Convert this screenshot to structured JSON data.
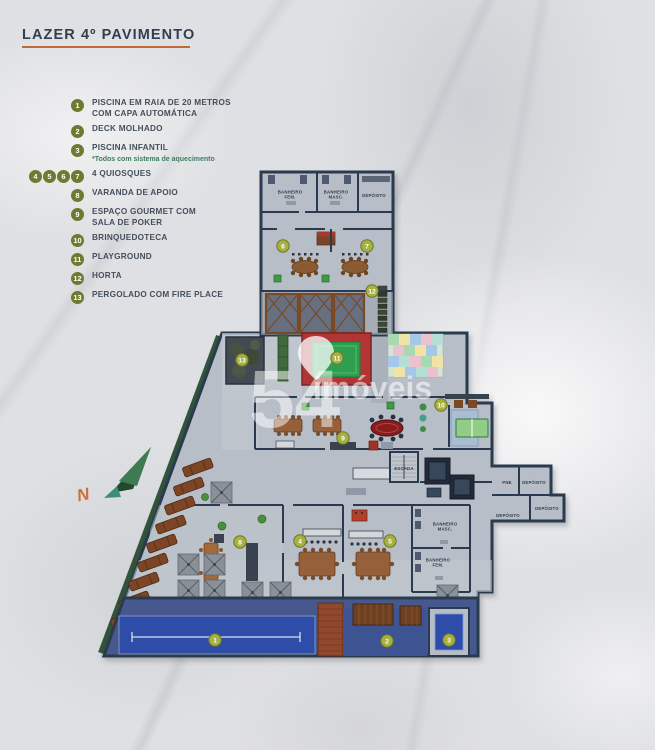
{
  "title": {
    "text": "LAZER 4º PAVIMENTO"
  },
  "legend": {
    "items": [
      {
        "numbers": [
          "1"
        ],
        "label": "PISCINA EM RAIA DE 20 METROS\nCOM CAPA AUTOMÁTICA",
        "note": ""
      },
      {
        "numbers": [
          "2"
        ],
        "label": "DECK MOLHADO",
        "note": ""
      },
      {
        "numbers": [
          "3"
        ],
        "label": "PISCINA INFANTIL",
        "note": "*Todos com sistema de aquecimento"
      },
      {
        "numbers": [
          "4",
          "5",
          "6",
          "7"
        ],
        "label": "4 QUIOSQUES",
        "note": ""
      },
      {
        "numbers": [
          "8"
        ],
        "label": "VARANDA DE APOIO",
        "note": ""
      },
      {
        "numbers": [
          "9"
        ],
        "label": "ESPAÇO GOURMET COM\nSALA DE POKER",
        "note": ""
      },
      {
        "numbers": [
          "10"
        ],
        "label": "BRINQUEDOTECA",
        "note": ""
      },
      {
        "numbers": [
          "11"
        ],
        "label": "PLAYGROUND",
        "note": ""
      },
      {
        "numbers": [
          "12"
        ],
        "label": "HORTA",
        "note": ""
      },
      {
        "numbers": [
          "13"
        ],
        "label": "PERGOLADO COM FIRE PLACE",
        "note": ""
      }
    ]
  },
  "plan": {
    "markers": [
      {
        "n": "1",
        "x": 215,
        "y": 640
      },
      {
        "n": "2",
        "x": 387,
        "y": 641
      },
      {
        "n": "3",
        "x": 449,
        "y": 640
      },
      {
        "n": "4",
        "x": 300,
        "y": 541
      },
      {
        "n": "5",
        "x": 390,
        "y": 541
      },
      {
        "n": "6",
        "x": 283,
        "y": 246
      },
      {
        "n": "7",
        "x": 367,
        "y": 246
      },
      {
        "n": "8",
        "x": 240,
        "y": 542
      },
      {
        "n": "9",
        "x": 343,
        "y": 438
      },
      {
        "n": "10",
        "x": 441,
        "y": 405
      },
      {
        "n": "11",
        "x": 337,
        "y": 358
      },
      {
        "n": "12",
        "x": 372,
        "y": 291
      },
      {
        "n": "13",
        "x": 242,
        "y": 360
      }
    ],
    "rooms": [
      {
        "label": "BANHEIRO\nFEM.",
        "x": 290,
        "y": 196
      },
      {
        "label": "BANHEIRO\nMASC.",
        "x": 336,
        "y": 196
      },
      {
        "label": "DEPÓSITO",
        "x": 374,
        "y": 197
      },
      {
        "label": "ESCADA",
        "x": 404,
        "y": 470
      },
      {
        "label": "PNE",
        "x": 507,
        "y": 484
      },
      {
        "label": "DEPÓSITO",
        "x": 534,
        "y": 484
      },
      {
        "label": "DEPÓSITO",
        "x": 547,
        "y": 510
      },
      {
        "label": "DEPÓSITO",
        "x": 508,
        "y": 517
      },
      {
        "label": "BANHEIRO\nMASC.",
        "x": 445,
        "y": 528
      },
      {
        "label": "BANHEIRO\nFEM.",
        "x": 438,
        "y": 564
      }
    ],
    "compass_label": "N"
  },
  "watermark": {
    "number": "54",
    "name": "imóveis"
  },
  "colors": {
    "accent_underline": "#c06a35",
    "legend_badge": "#6d7a2f",
    "marker": "#a6b13f",
    "marker_ring": "#6d7728",
    "wall": "#2c3a4f",
    "floor": "#b8bec7",
    "pool_water": "#2d4da8",
    "playground_red": "#b23535",
    "playground_green": "#2e9e4f",
    "note_green": "#3e7d5c",
    "text": "#454f5c"
  }
}
